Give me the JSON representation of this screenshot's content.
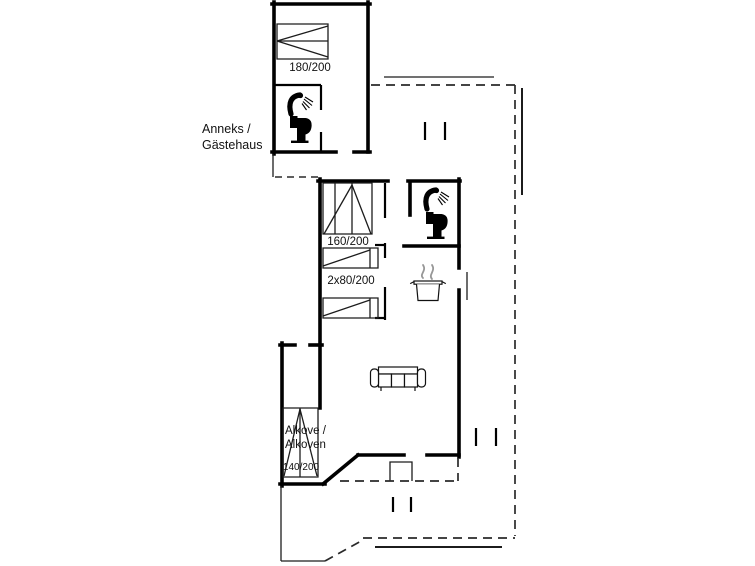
{
  "colors": {
    "line": "#000000",
    "background": "#ffffff",
    "steam": "#999999"
  },
  "plan": {
    "annex": {
      "label_line1": "Anneks /",
      "label_line2": "Gästehaus",
      "bed_size": "180/200"
    },
    "main_house": {
      "bedroom": {
        "double_bed_size": "160/200",
        "single_beds_size": "2x80/200"
      },
      "alcove": {
        "label_line1": "Alkove /",
        "label_line2": "Alkoven",
        "bed_size": "140/200"
      }
    },
    "icons": {
      "annex_shower": "shower-icon",
      "annex_toilet": "toilet-icon",
      "main_shower": "shower-icon",
      "main_toilet": "toilet-icon",
      "kitchen_pot": "cooking-pot-icon",
      "living_room_sofa": "sofa-icon"
    }
  }
}
